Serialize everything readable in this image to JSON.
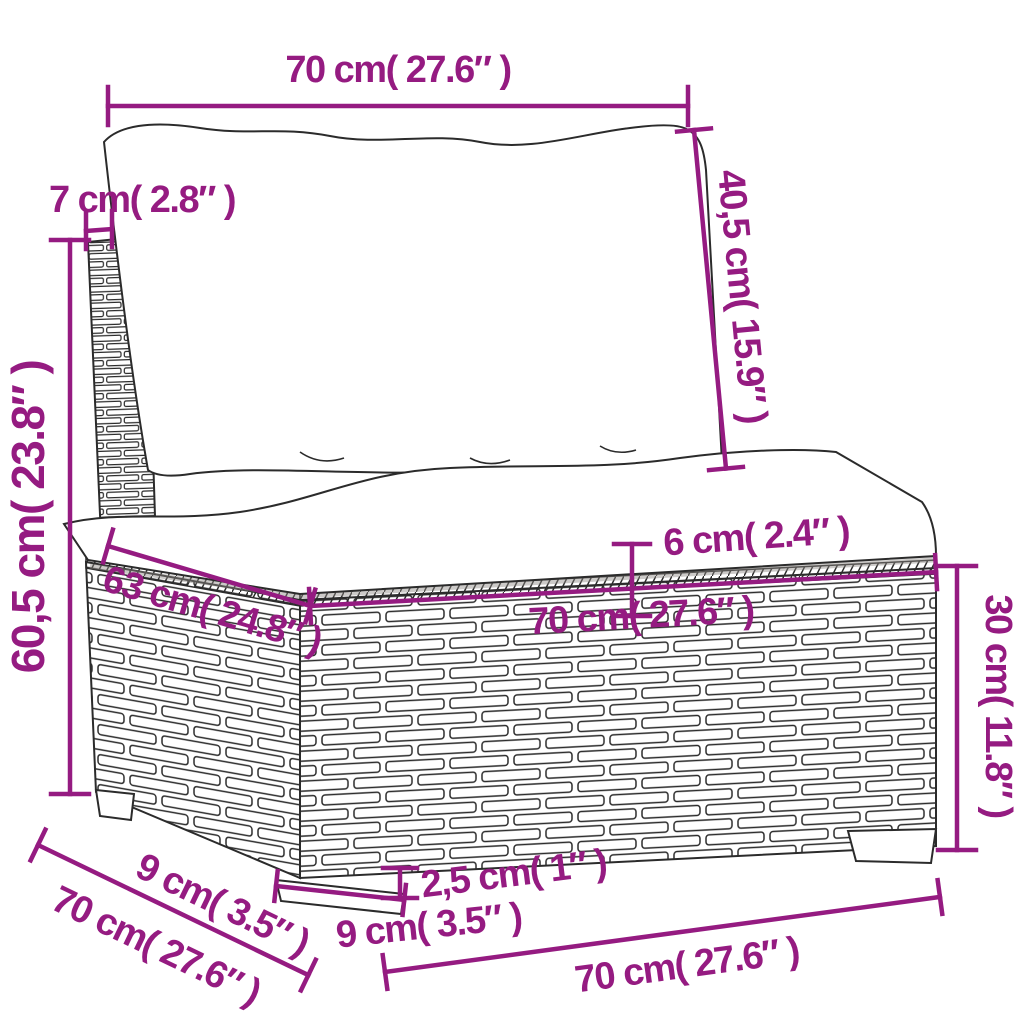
{
  "diagram": {
    "subject": "poly rattan sofa middle section with cushions",
    "accent_color": "#951b81",
    "outline_color": "#2b2b2b",
    "background_color": "#ffffff"
  },
  "labels": {
    "back_cushion_width": "70 cm( 27.6″ )",
    "back_cushion_height": "40,5 cm( 15.9″ )",
    "back_panel_thickness": "7 cm( 2.8″ )",
    "total_height": "60,5 cm( 23.8″ )",
    "seat_depth": "63 cm( 24.8″ )",
    "seat_width": "70 cm( 27.6″ )",
    "seat_cushion_thickness": "6 cm( 2.4″ )",
    "base_height": "30 cm( 11.8″ )",
    "leg_side_width": "9 cm( 3.5″ )",
    "total_depth": "70 cm( 27.6″ )",
    "leg_height": "2,5 cm( 1″ )",
    "leg_front_width": "9 cm( 3.5″ )",
    "total_width": "70 cm( 27.6″ )"
  }
}
